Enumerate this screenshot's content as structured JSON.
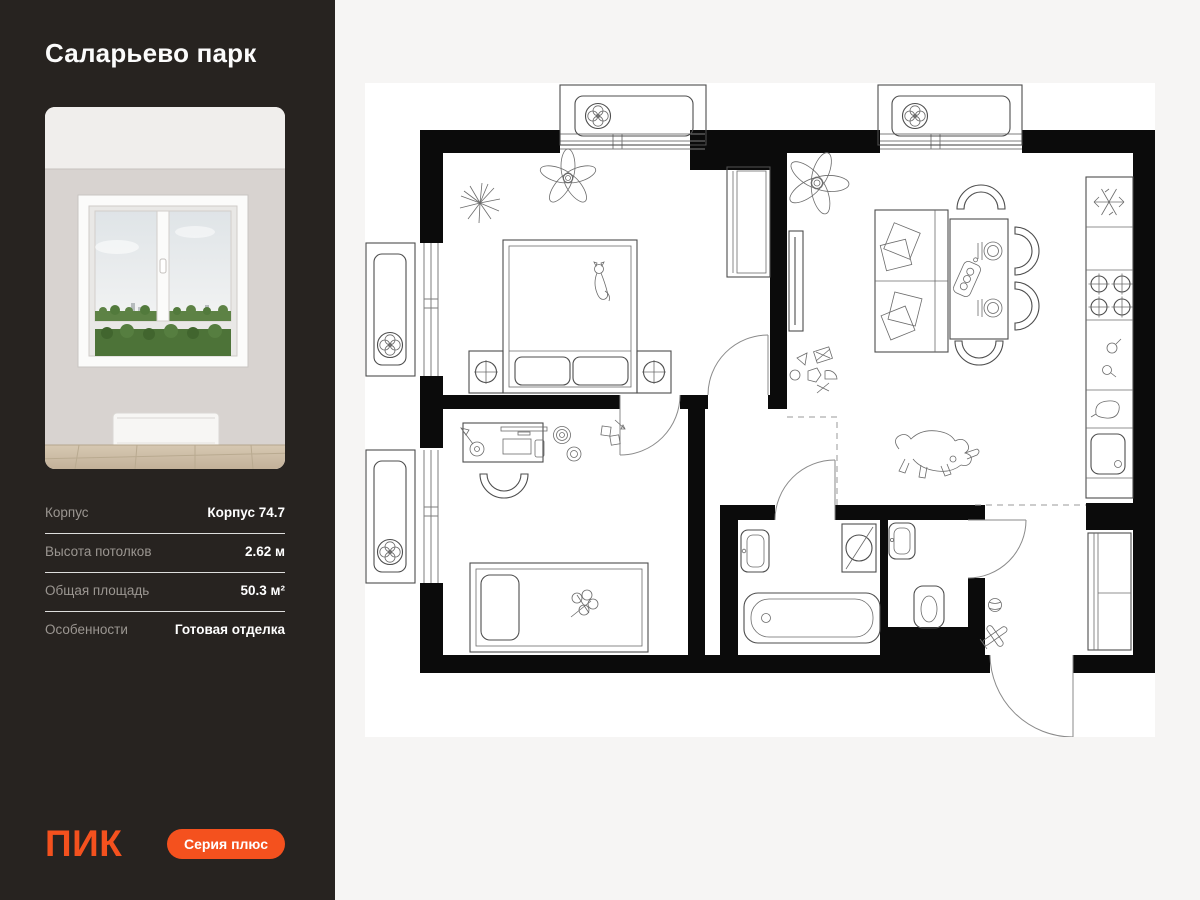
{
  "sidebar": {
    "project_title": "Саларьево парк",
    "details": [
      {
        "label": "Корпус",
        "value": "Корпус 74.7"
      },
      {
        "label": "Высота потолков",
        "value": "2.62 м"
      },
      {
        "label": "Общая площадь",
        "value": "50.3 м²"
      },
      {
        "label": "Особенности",
        "value": "Готовая отделка"
      }
    ],
    "logo_text": "ПИК",
    "badge_label": "Серия плюс"
  },
  "colors": {
    "accent_orange": "#F4511E",
    "sidebar_background": "#272320",
    "panel_background": "#F6F5F4",
    "plan_sheet_background": "#FFFFFF",
    "wall_black": "#0B0B0B"
  },
  "floor_plan": {
    "text_labels": [],
    "icons": [
      "fan-icon",
      "snowflake-icon",
      "stove-burner-icon",
      "kitchen-sink-icon",
      "kettle-icon",
      "bathtub-icon",
      "toilet-icon",
      "washing-machine-icon",
      "bed-double",
      "bed-single",
      "sofa",
      "dining-table",
      "chair",
      "desk",
      "wardrobe",
      "tv-unit",
      "plant",
      "flower",
      "cat-drawing",
      "dog-drawing",
      "door-arc",
      "window",
      "air-conditioner-box"
    ]
  }
}
